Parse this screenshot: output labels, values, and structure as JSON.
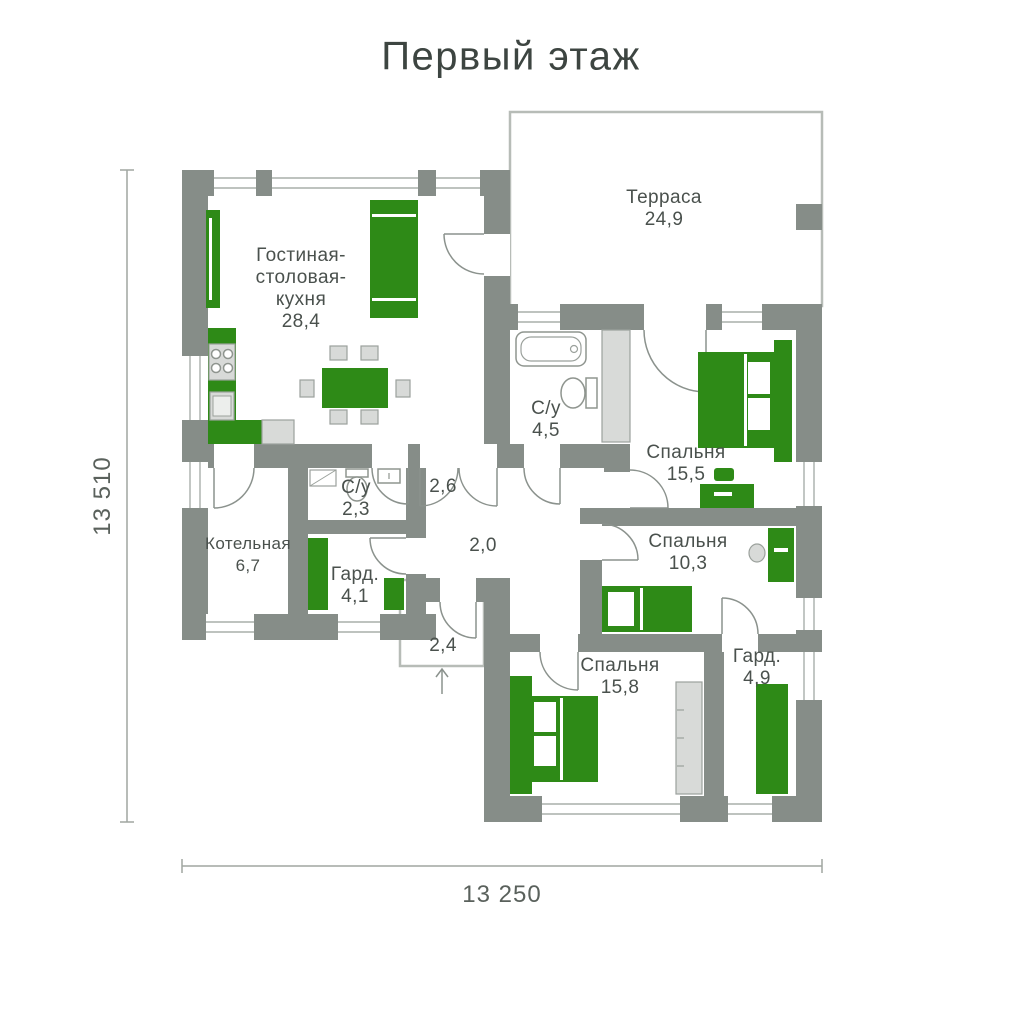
{
  "title": "Первый этаж",
  "dimensions": {
    "height": "13 510",
    "width": "13 250"
  },
  "colors": {
    "wall": "#868D88",
    "furniture": "#2E8A17",
    "appliance": "#D8DAD8",
    "text": "#4A514D"
  },
  "rooms": {
    "living": {
      "name_line1": "Гостиная-",
      "name_line2": "столовая-",
      "name_line3": "кухня",
      "area": "28,4"
    },
    "terrace": {
      "name": "Терраса",
      "area": "24,9"
    },
    "bathroom_main": {
      "name": "С/у",
      "area": "4,5"
    },
    "bedroom_1": {
      "name": "Спальня",
      "area": "15,5"
    },
    "bathroom_small": {
      "name": "С/у",
      "area": "2,3"
    },
    "hallway_1": {
      "area": "2,6"
    },
    "boiler": {
      "name": "Котельная",
      "area": "6,7"
    },
    "wardrobe_1": {
      "name": "Гард.",
      "area": "4,1"
    },
    "hallway_2": {
      "area": "2,0"
    },
    "bedroom_2": {
      "name": "Спальня",
      "area": "10,3"
    },
    "entrance": {
      "area": "2,4"
    },
    "bedroom_3": {
      "name": "Спальня",
      "area": "15,8"
    },
    "wardrobe_2": {
      "name": "Гард.",
      "area": "4,9"
    }
  }
}
